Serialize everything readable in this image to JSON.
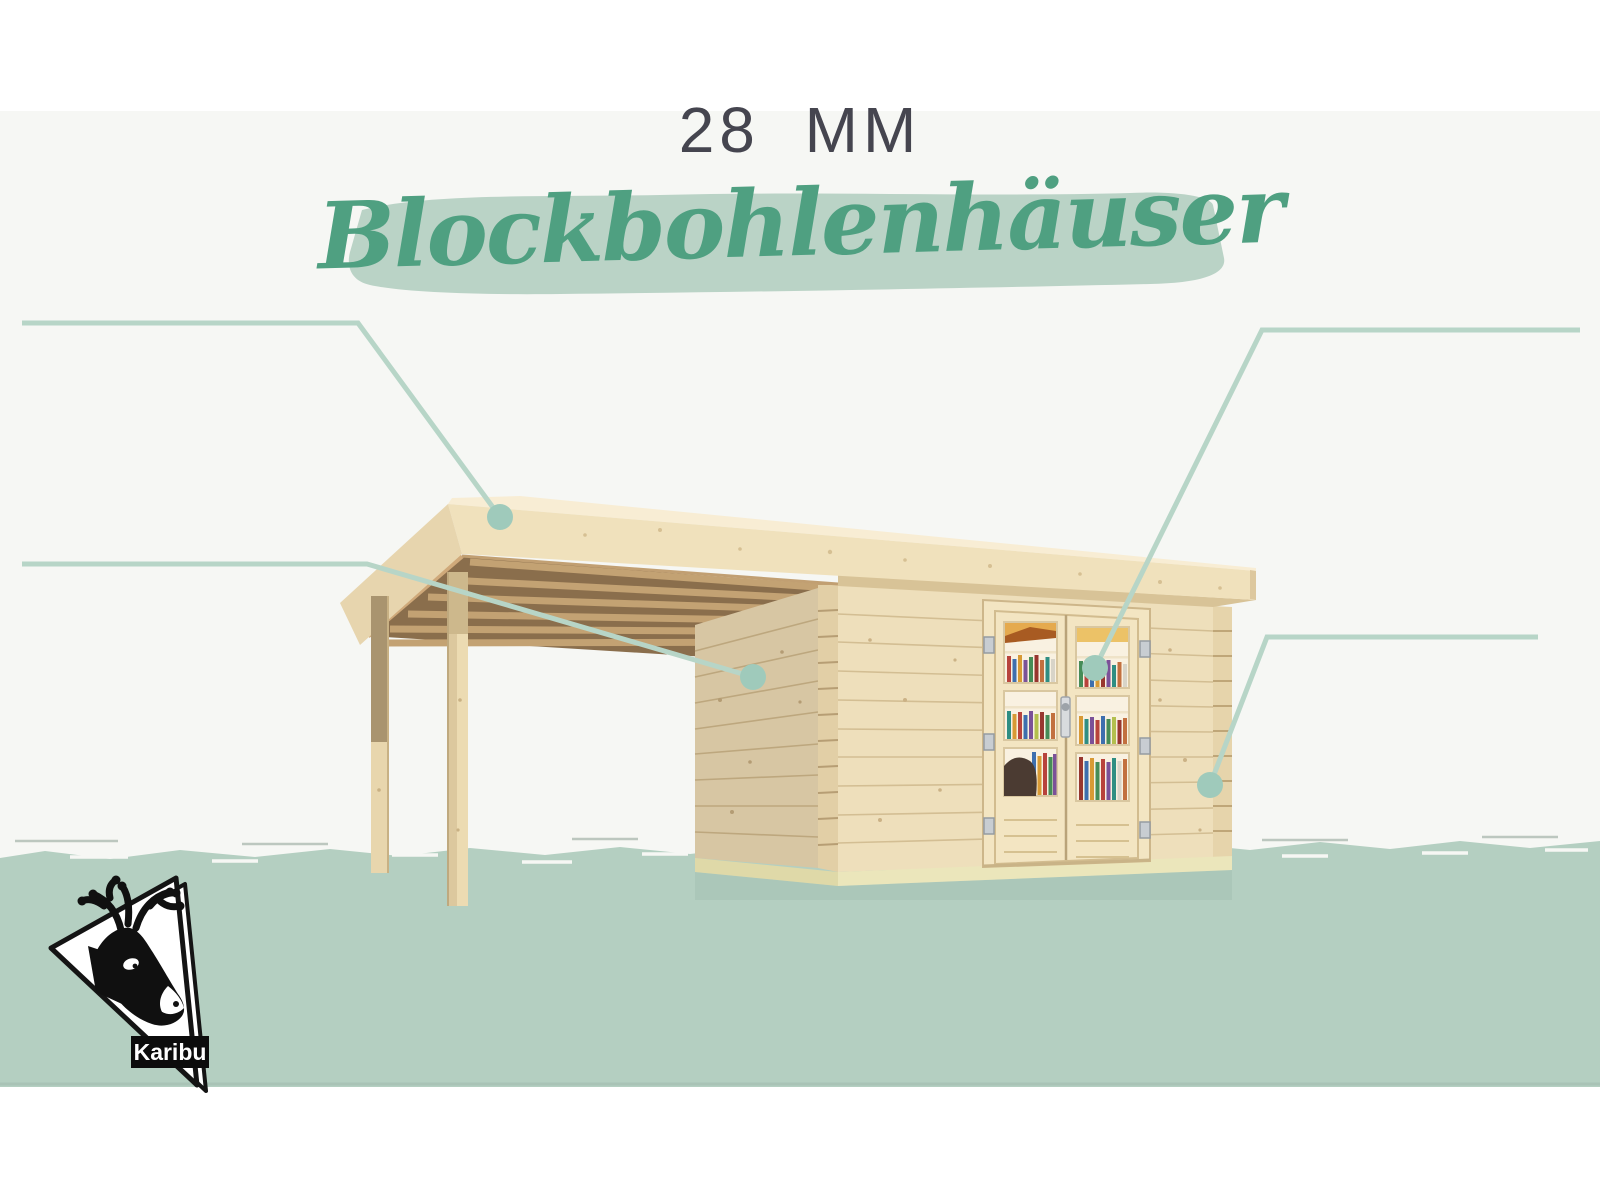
{
  "header": {
    "thickness_label": "28 MM",
    "product_title": "Blockbohlenhäuser"
  },
  "features": {
    "left_top": [
      "Dach aus Massivholz",
      "Weite Dachüberstände\nbieten Witterungsschutz",
      "Teilweise im Set mit\nAnbaudach erhältlich"
    ],
    "left_bottom": [
      "28 mm starke Block-\nbohlenbauweise",
      "Perfekter Nut- und\nFedersitz durch mo-\ndernste Frästechnik",
      "Wasserabweisende\nProfilierung"
    ],
    "right_top": [
      "Inkl. Doppelflügeltür\nmit Buntbart- oder\nZylinderschloss und\nSchlüsseln",
      "Lichtausschnitte aus\nbruchsicherem Kunst-\nglas"
    ],
    "right_bottom": [
      "Patentierte 6-Plus-\nEckverbindung",
      "Wartungsfrei,\nwind- und regen-\ndicht"
    ]
  },
  "logo": {
    "brand": "Karibu"
  },
  "colors": {
    "accent_green": "#4fa081",
    "highlight_band": "#bad3c6",
    "ground_band": "#b4cfc1",
    "callout_line": "#b7d5c7",
    "callout_dot": "#9fcabb",
    "text_gray": "#4d4d55"
  }
}
